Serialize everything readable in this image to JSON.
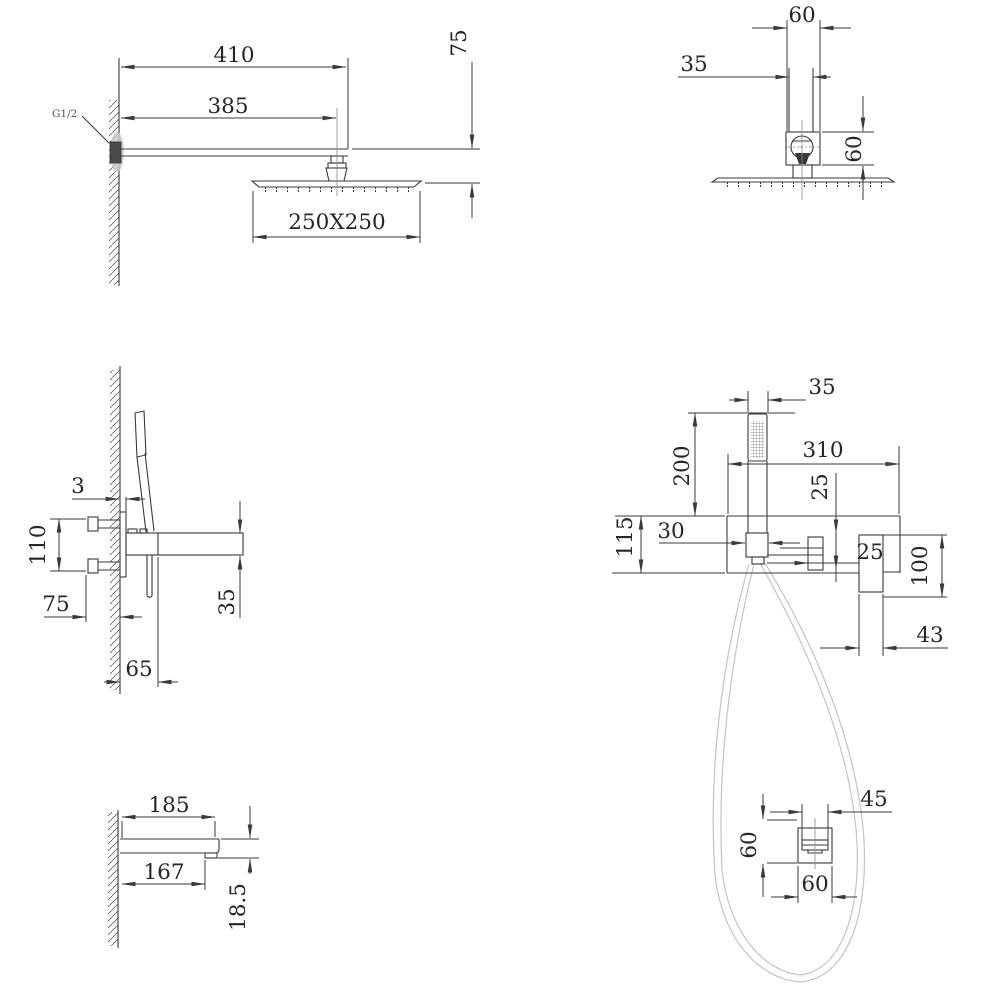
{
  "drawing": {
    "type": "technical-dimension-drawing",
    "views": {
      "shower_arm_side": {
        "d410": "410",
        "d385": "385",
        "d250x250": "250X250",
        "d75": "75",
        "thread_label": "G1/2"
      },
      "shower_head_front": {
        "d60_width": "60",
        "d35": "35",
        "d60_height": "60"
      },
      "mixer_side": {
        "d3": "3",
        "d110": "110",
        "d75": "75",
        "d35": "35",
        "d65": "65"
      },
      "mixer_front": {
        "d35": "35",
        "d200": "200",
        "d310": "310",
        "d25_offset": "25",
        "d30": "30",
        "d115": "115",
        "d25_outlet": "25",
        "d100": "100",
        "d43": "43"
      },
      "spout_side": {
        "d185": "185",
        "d167": "167",
        "d18_5": "18.5"
      },
      "wall_outlet_front": {
        "d45": "45",
        "d60_height": "60",
        "d60_width": "60"
      }
    },
    "colors": {
      "line": "#3a3a3a",
      "text": "#262626",
      "hose": "#c3c3c3",
      "wall_shadow": "#c9c9c9",
      "dark_fitting": "#4a4a4a"
    }
  }
}
